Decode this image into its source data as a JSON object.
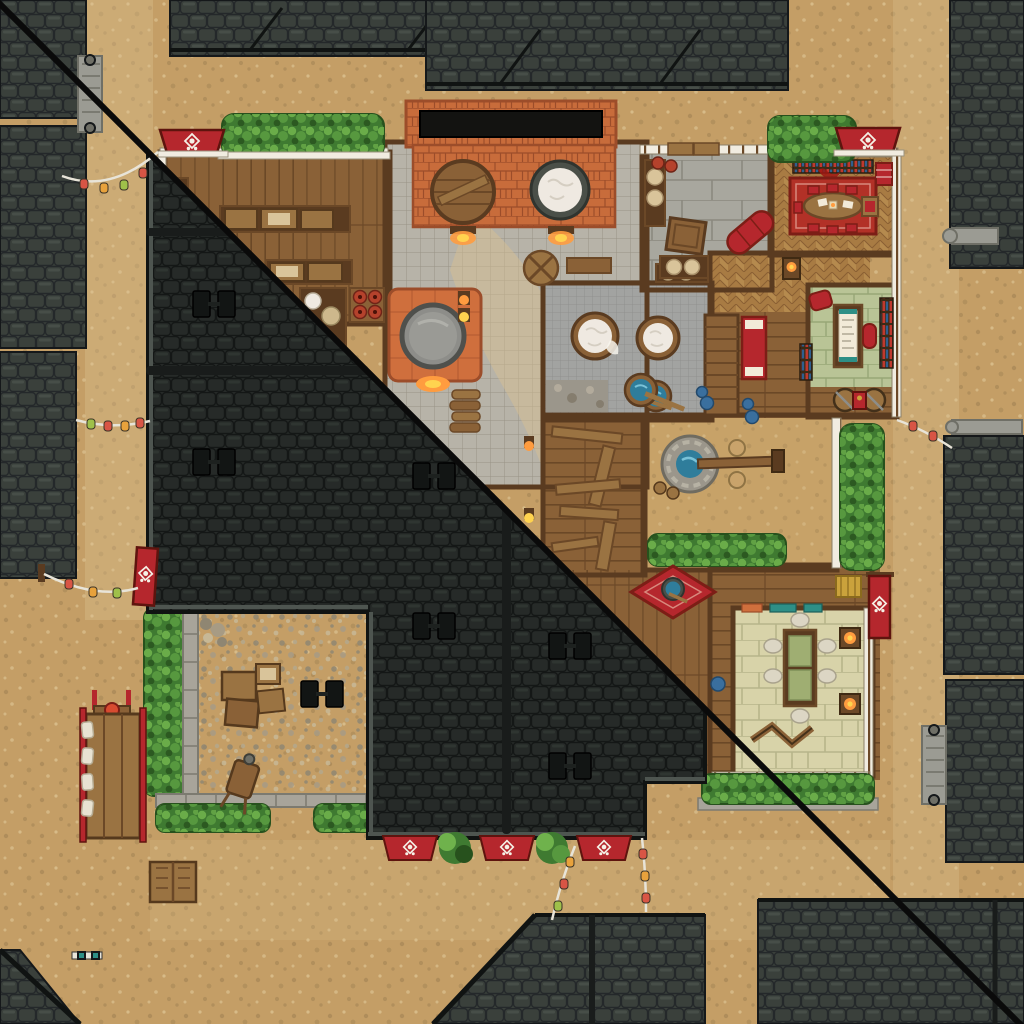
{
  "meta": {
    "alt": "Top-down tabletop battle map of a Japanese sake brewery inn, split diagonally: lower-left shows the dark tiled roof, upper-right shows the interior rooms",
    "view_split": {
      "lower_left": "roof view",
      "upper_right": "interior view"
    }
  },
  "palette": {
    "dirt": "#c49e66",
    "dirt2": "#c7a268",
    "dirt_dark": "#9e8052",
    "dirt_light": "#dcc291",
    "roof_n": "#3a403b",
    "roof_n_dark": "#24282a",
    "roof_n_light": "#545c55",
    "roof_m": "#262a28",
    "roof_m_dark": "#141716",
    "roof_m_light": "#373d39",
    "ridge": "#191c1b",
    "beam": "#101312",
    "wood": "#8a6137",
    "wood_line": "#6b4827",
    "wood_dark": "#5a3b20",
    "wood_mid": "#9a7342",
    "wall_white": "#f1ece0",
    "wall_tick": "#6b4827",
    "tile": "#b7b3a8",
    "tile_line": "#989386",
    "slab": "#a8a79e",
    "slab_line": "#8b897f",
    "mosaic": "#a2a3a1",
    "mosaic_line": "#8b8c8a",
    "brick": "#c86c3b",
    "brick_line": "#9c4d2a",
    "hearth": "#cf6f3d",
    "herring_a": "#a87b43",
    "herring_b": "#b58a4e",
    "herring_line": "#8a5f33",
    "tatami_g": "#b9c496",
    "tatami_g_line": "#97a676",
    "tatami_c": "#d8d3a9",
    "tatami_c_line": "#b7b58a",
    "red": "#b5272d",
    "red_dark": "#7c1e16",
    "rug": "#b23127",
    "hedge": "#3f7a31",
    "hedge_dark": "#27511d",
    "hedge_light": "#6fb24c",
    "hedge_mid": "#57983f",
    "water": "#2f7d9b",
    "water_light": "#79c2d8",
    "rice": "#efe9e1",
    "paper": "#f2ead8",
    "glow": "#ff9c3f",
    "glow_hot": "#ffd34f",
    "stone_wall": "#a8a49a",
    "stone_wall_line": "#7c7a70",
    "metal": "#9b9b93",
    "metal_dark": "#6f6f66",
    "book_red": "#c0392e",
    "book_blue": "#2f5f8f",
    "teal": "#2e8f86",
    "gold": "#caa23c",
    "lantern_red": "#d85545",
    "lantern_yellow": "#e8a23c",
    "lantern_green": "#9fc04a",
    "string": "#e8e4d8",
    "cut_line": "#0a0a0a",
    "white_cloth": "#e8e2d2"
  },
  "map_features": {
    "building": "sake brewery inn",
    "banner_crest": "white blossom crest on red banners",
    "rooms": [
      "storeroom",
      "brewery hall with brick kiln and vats",
      "cauldron hearth",
      "rice bath room",
      "entry hall",
      "dining room with red rug",
      "study with tatami and writing desk",
      "inner courtyard with well",
      "plank workshop",
      "tatami banquet room",
      "stair hall with futon"
    ],
    "exterior": [
      "dirt streets with gravel",
      "neighbor tiled roofs",
      "hedges",
      "stone yard wall",
      "hand cart",
      "crates",
      "wheelbarrow",
      "lantern strings",
      "red noren banners on eaves",
      "market stall table"
    ]
  }
}
